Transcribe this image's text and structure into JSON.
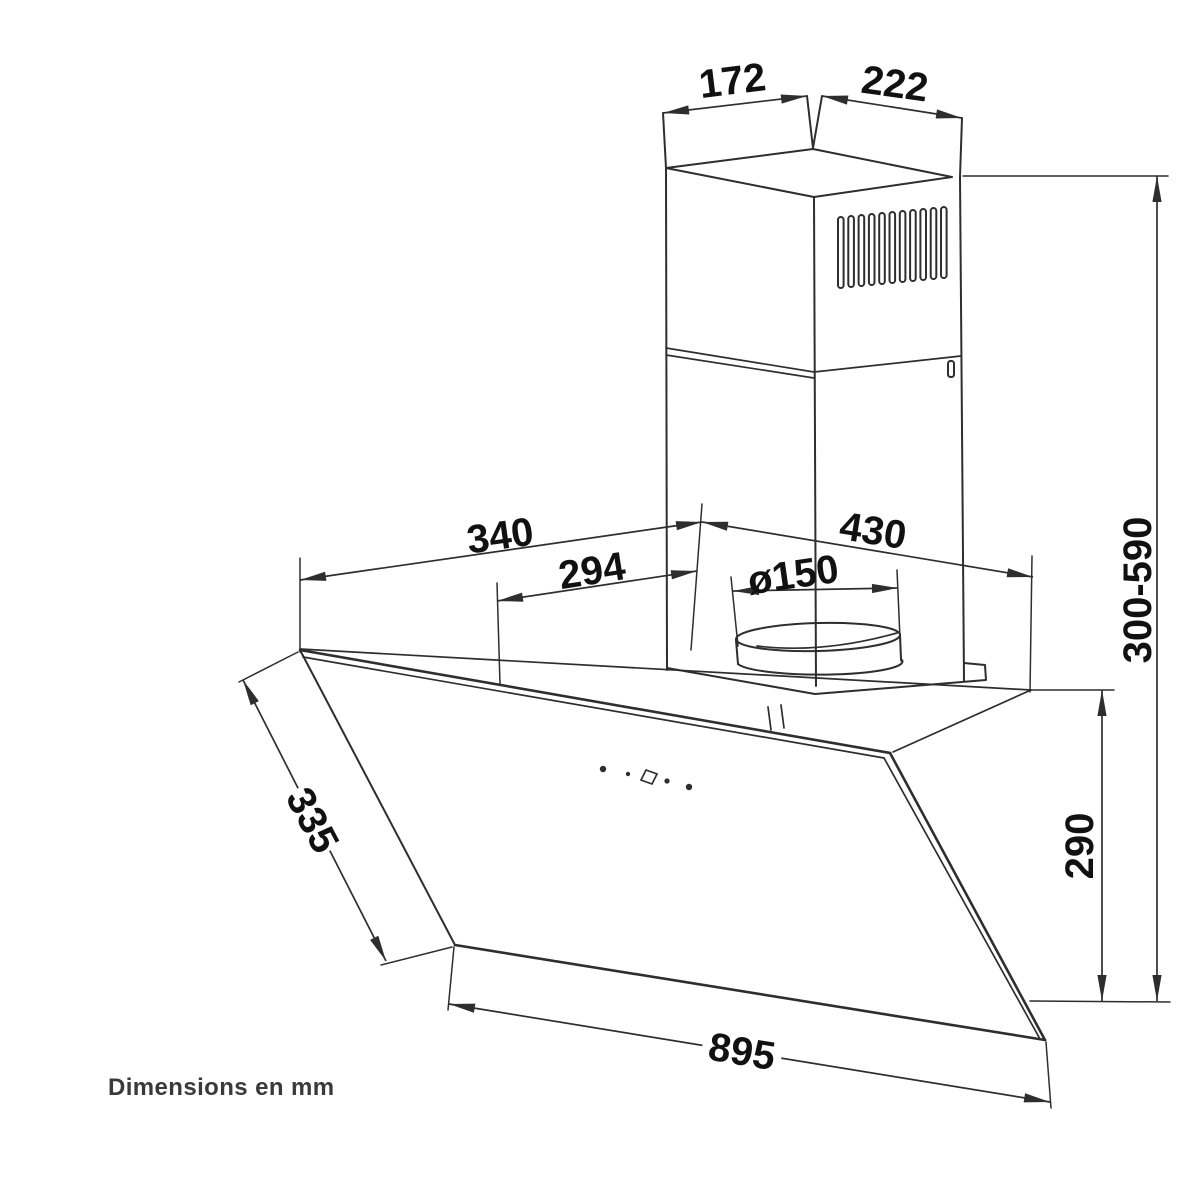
{
  "dimensions": {
    "chimney_top_width": "172",
    "chimney_top_depth": "222",
    "top_left_span": "340",
    "top_inner_span": "294",
    "top_right_span": "430",
    "duct_diameter": "ø150",
    "chimney_height_range": "300-590",
    "body_height": "290",
    "panel_depth": "335",
    "hood_width": "895"
  },
  "footer": {
    "units_note": "Dimensions en mm"
  },
  "colors": {
    "line": "#2e2e2e",
    "label": "#111111",
    "footer": "#3a3a3a",
    "background": "#ffffff"
  }
}
